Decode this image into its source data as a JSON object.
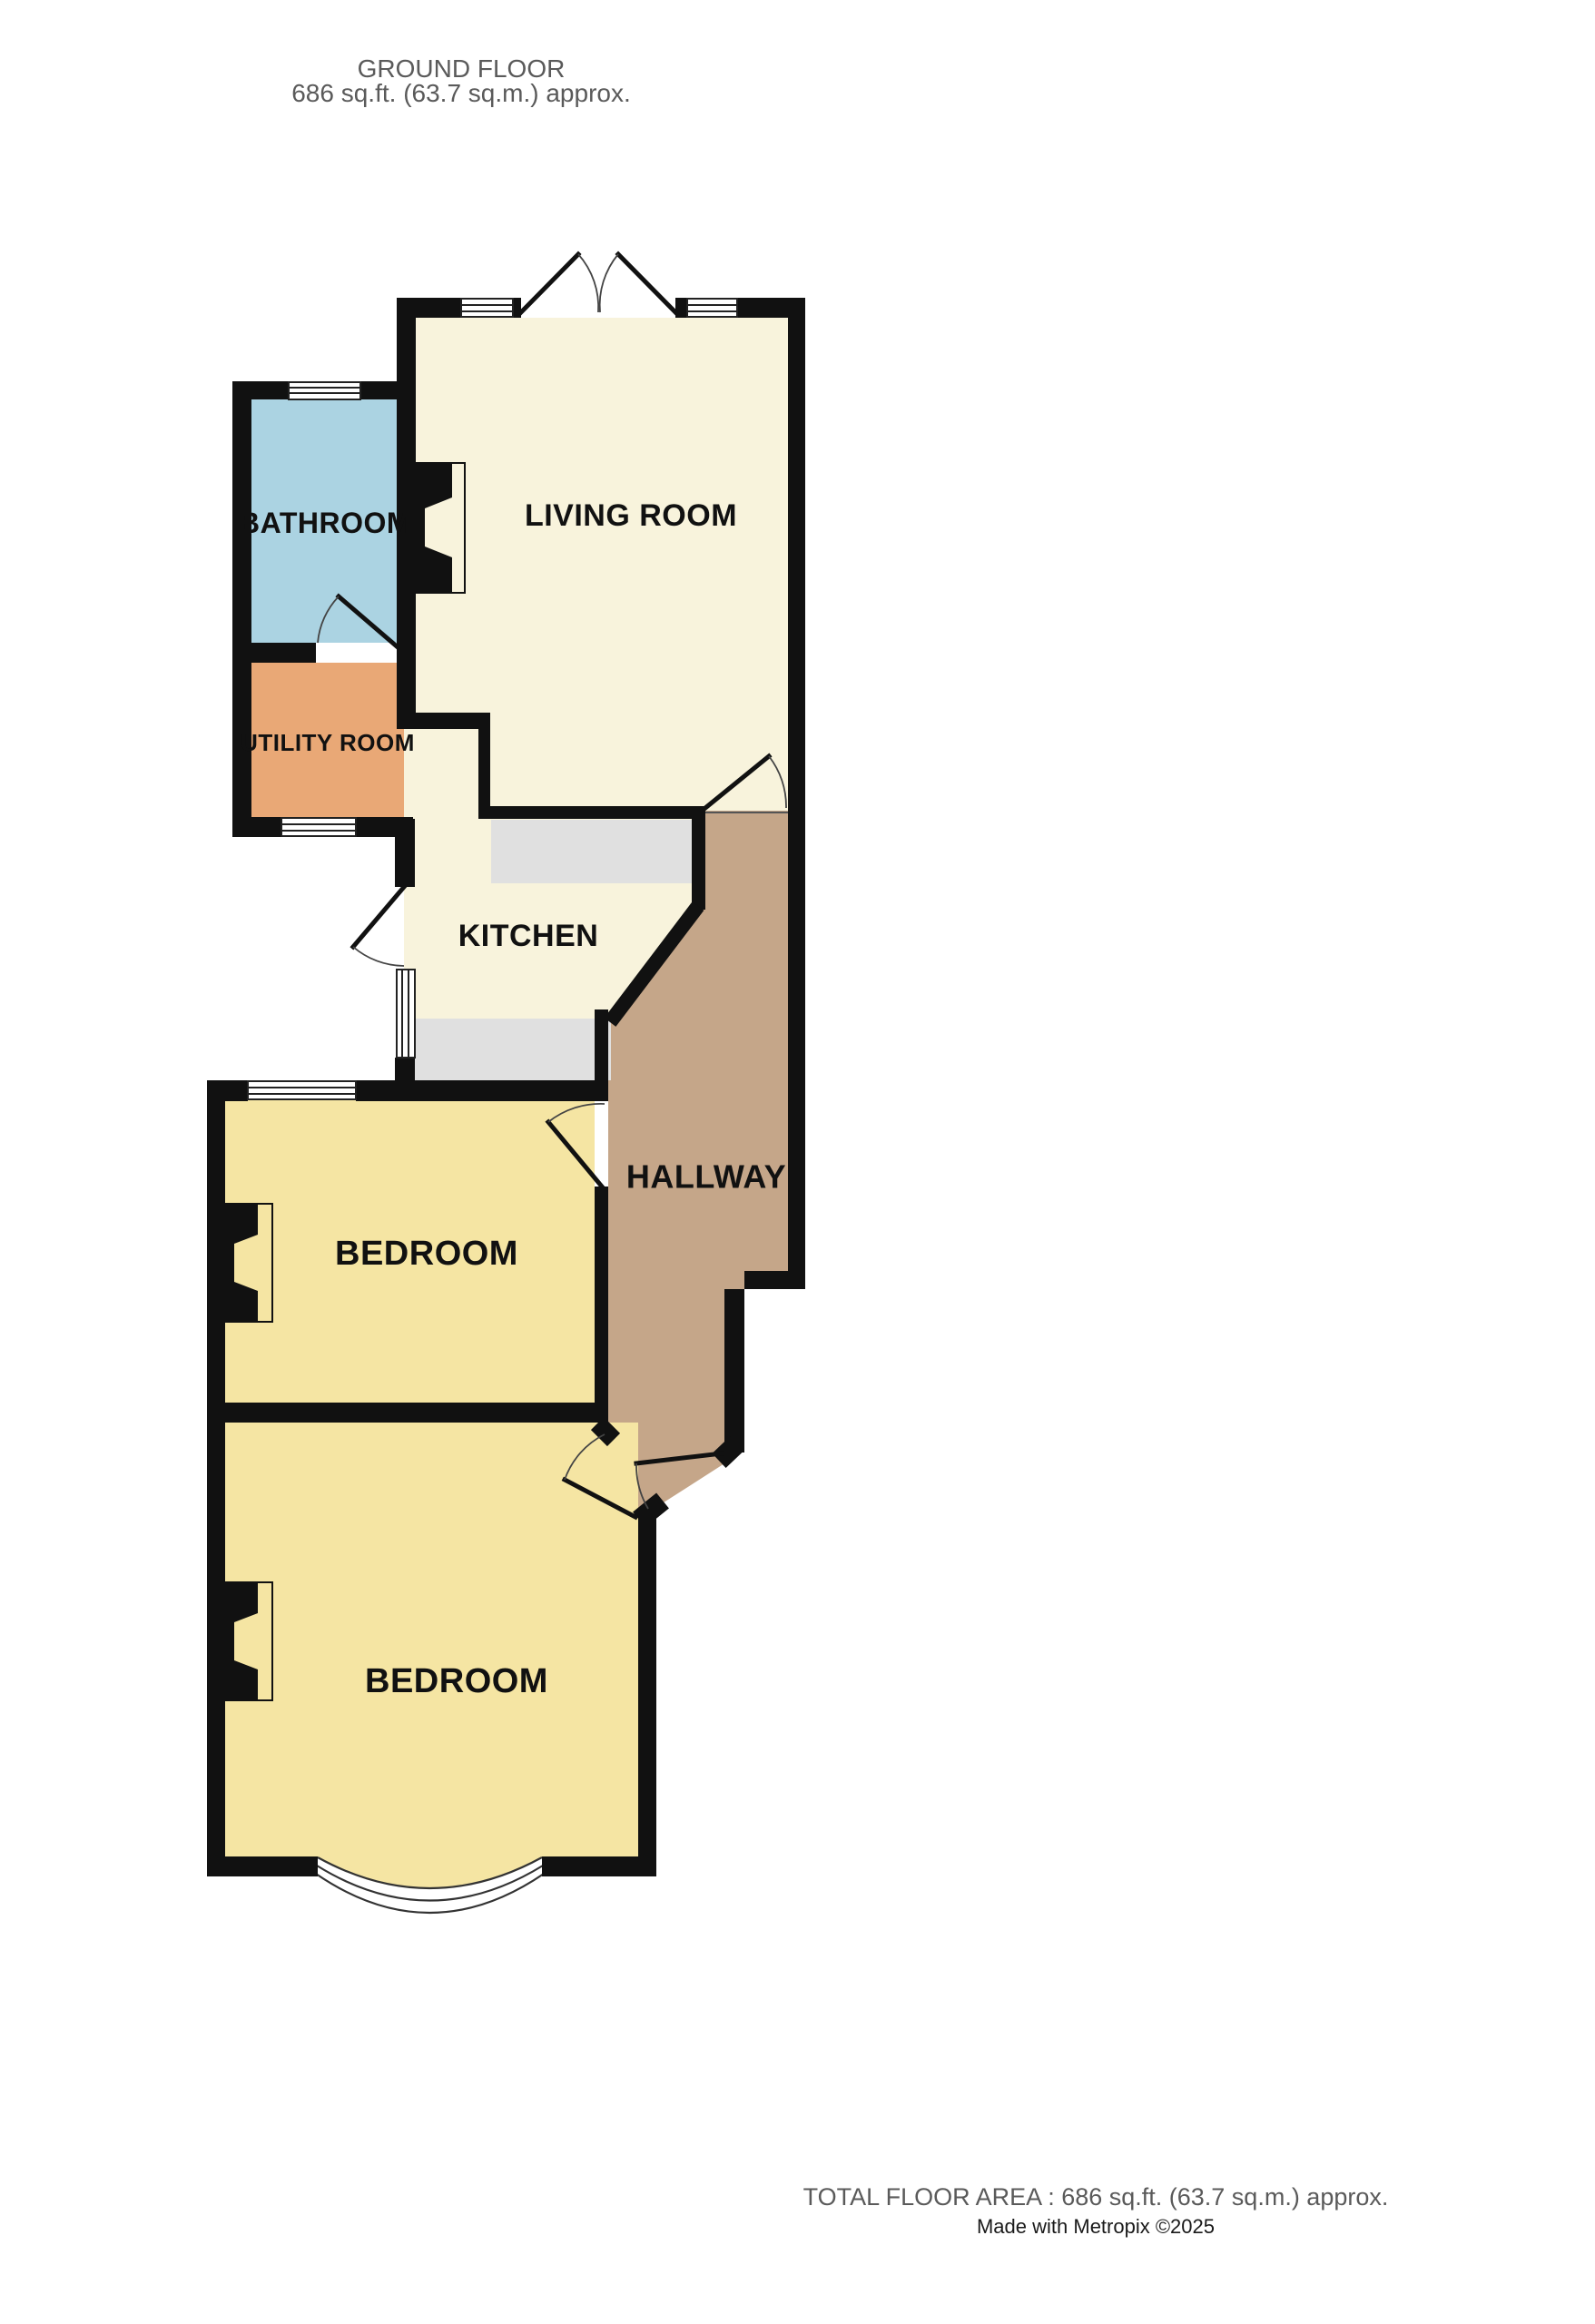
{
  "header": {
    "line1": "GROUND FLOOR",
    "line2": "686 sq.ft. (63.7 sq.m.) approx."
  },
  "rooms": {
    "living_room": {
      "label": "LIVING ROOM",
      "color": "#f8f3dc"
    },
    "kitchen": {
      "label": "KITCHEN",
      "color": "#f8f3dc"
    },
    "bathroom": {
      "label": "BATHROOM",
      "color": "#abd3e2"
    },
    "utility_room": {
      "label": "UTILITY ROOM",
      "color": "#e9a876"
    },
    "hallway": {
      "label": "HALLWAY",
      "color": "#c5a689"
    },
    "bedroom_front": {
      "label": "BEDROOM",
      "color": "#f5e5a3"
    },
    "bedroom_back": {
      "label": "BEDROOM",
      "color": "#f5e5a3"
    }
  },
  "palette": {
    "wall": "#111111",
    "counter": "#e0e0e0",
    "window_fill": "#ffffff",
    "bay_fill": "#ffffff",
    "text_gray": "#5a5a5a",
    "text_black": "#1a1a1a"
  },
  "footer": {
    "line1": "TOTAL FLOOR AREA : 686 sq.ft. (63.7 sq.m.) approx.",
    "line2": "Made with Metropix ©2025"
  }
}
